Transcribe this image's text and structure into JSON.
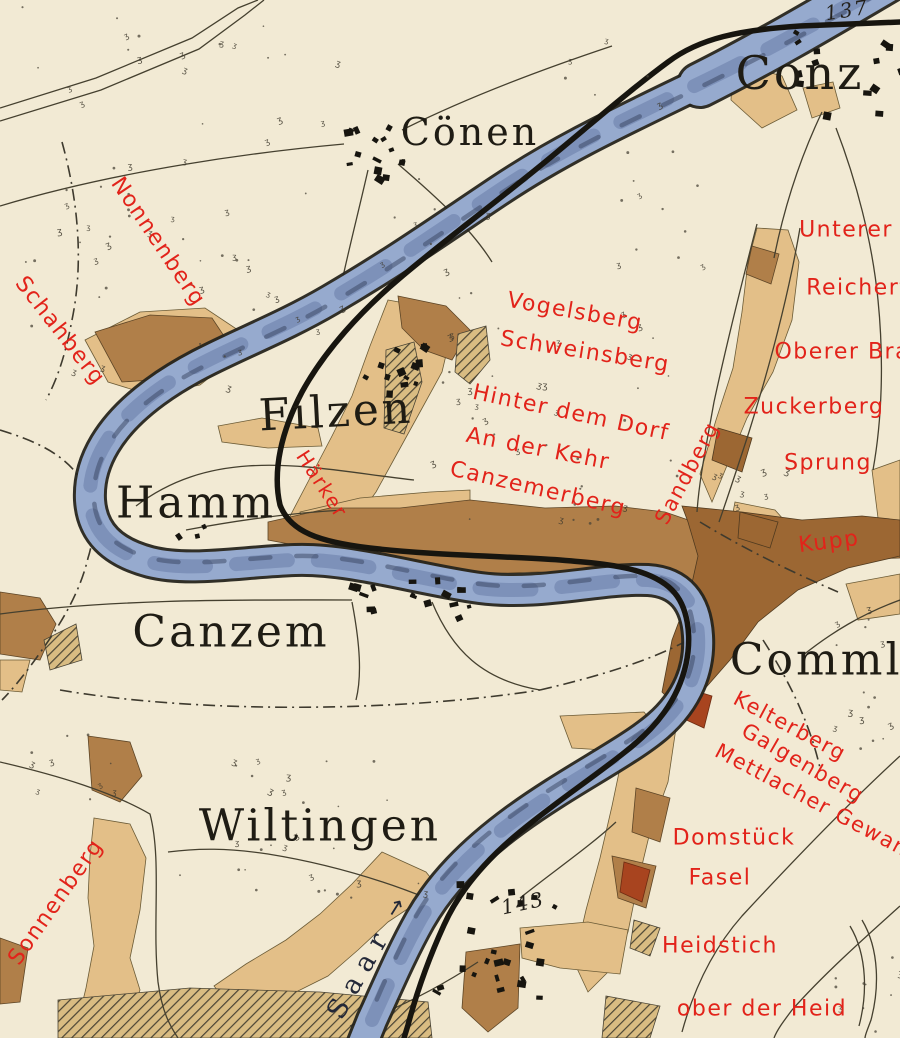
{
  "map_type": "historical topographic wine map",
  "colors": {
    "paper": "#f2ead4",
    "tan": "#e3bf88",
    "brown": "#b07f49",
    "brown2": "#9c6733",
    "redbrown": "#a8441f",
    "river": "#96aace",
    "bank": "#26251d",
    "ink": "#17150f",
    "red": "#e2231a",
    "road": "#45402f",
    "town": "#1f1c14",
    "hydro": "#232838"
  },
  "river": {
    "name": "Saar",
    "arrow": "→"
  },
  "labels": [
    {
      "text": "Cönen",
      "x": 470,
      "y": 132,
      "rot": 0,
      "cls": "town",
      "size": 38
    },
    {
      "text": "Conz",
      "x": 800,
      "y": 73,
      "rot": 0,
      "cls": "town",
      "size": 46
    },
    {
      "text": "Filzen",
      "x": 336,
      "y": 412,
      "rot": -3,
      "cls": "town",
      "size": 44
    },
    {
      "text": "Hamm",
      "x": 196,
      "y": 503,
      "rot": 0,
      "cls": "town",
      "size": 44
    },
    {
      "text": "Canzem",
      "x": 231,
      "y": 632,
      "rot": 0,
      "cls": "town",
      "size": 44
    },
    {
      "text": "Wiltingen",
      "x": 320,
      "y": 826,
      "rot": 0,
      "cls": "town",
      "size": 44
    },
    {
      "text": "Commling",
      "x": 856,
      "y": 660,
      "rot": 0,
      "cls": "town",
      "size": 44
    },
    {
      "text": "137",
      "x": 847,
      "y": 10,
      "rot": -9,
      "cls": "elev",
      "size": 20
    },
    {
      "text": "143",
      "x": 523,
      "y": 903,
      "rot": -12,
      "cls": "elev",
      "size": 20
    },
    {
      "text": "Saar",
      "x": 360,
      "y": 972,
      "rot": -60,
      "cls": "hydro",
      "size": 27
    },
    {
      "text": "→",
      "x": 396,
      "y": 908,
      "rot": -58,
      "cls": "hydro-arrow",
      "size": 22
    },
    {
      "text": "Nonnenberg",
      "x": 158,
      "y": 242,
      "rot": 56,
      "cls": "vineyard",
      "size": 22
    },
    {
      "text": "Schahberg",
      "x": 60,
      "y": 331,
      "rot": 52,
      "cls": "vineyard",
      "size": 22
    },
    {
      "text": "Unterer",
      "x": 846,
      "y": 230,
      "rot": 0,
      "cls": "vineyard",
      "size": 22
    },
    {
      "text": "Reichertsb",
      "x": 872,
      "y": 288,
      "rot": 0,
      "cls": "vineyard",
      "size": 22
    },
    {
      "text": "Oberer Brau",
      "x": 850,
      "y": 352,
      "rot": 0,
      "cls": "vineyard",
      "size": 22
    },
    {
      "text": "Zuckerberg",
      "x": 814,
      "y": 407,
      "rot": 0,
      "cls": "vineyard",
      "size": 22
    },
    {
      "text": "Sprung",
      "x": 828,
      "y": 463,
      "rot": 0,
      "cls": "vineyard",
      "size": 22
    },
    {
      "text": "Vogelsberg",
      "x": 575,
      "y": 312,
      "rot": 10,
      "cls": "vineyard",
      "size": 22
    },
    {
      "text": "Schweinsberg",
      "x": 585,
      "y": 352,
      "rot": 9,
      "cls": "vineyard",
      "size": 22
    },
    {
      "text": "Hinter dem Dorf",
      "x": 571,
      "y": 413,
      "rot": 12,
      "cls": "vineyard",
      "size": 22
    },
    {
      "text": "An der Kehr",
      "x": 538,
      "y": 449,
      "rot": 11,
      "cls": "vineyard",
      "size": 22
    },
    {
      "text": "Canzemerberg",
      "x": 538,
      "y": 489,
      "rot": 13,
      "cls": "vineyard",
      "size": 22
    },
    {
      "text": "Sandberg",
      "x": 687,
      "y": 473,
      "rot": -62,
      "cls": "vineyard",
      "size": 21
    },
    {
      "text": "Härker",
      "x": 322,
      "y": 484,
      "rot": 57,
      "cls": "vineyard",
      "size": 20
    },
    {
      "text": "Kupp",
      "x": 829,
      "y": 542,
      "rot": -7,
      "cls": "vineyard",
      "size": 22
    },
    {
      "text": "Kelterberg",
      "x": 790,
      "y": 726,
      "rot": 28,
      "cls": "vineyard",
      "size": 21
    },
    {
      "text": "Galgenberg",
      "x": 803,
      "y": 763,
      "rot": 30,
      "cls": "vineyard",
      "size": 21
    },
    {
      "text": "Mettlacher Gewan",
      "x": 812,
      "y": 800,
      "rot": 28,
      "cls": "vineyard",
      "size": 21
    },
    {
      "text": "Domstück",
      "x": 734,
      "y": 838,
      "rot": 0,
      "cls": "vineyard",
      "size": 22
    },
    {
      "text": "Fasel",
      "x": 720,
      "y": 878,
      "rot": 0,
      "cls": "vineyard",
      "size": 22
    },
    {
      "text": "Heidstich",
      "x": 720,
      "y": 946,
      "rot": 0,
      "cls": "vineyard",
      "size": 22
    },
    {
      "text": "ober der Heid",
      "x": 762,
      "y": 1009,
      "rot": 0,
      "cls": "vineyard",
      "size": 22
    },
    {
      "text": "Sonnenberg",
      "x": 56,
      "y": 902,
      "rot": -55,
      "cls": "vineyard",
      "size": 22
    }
  ],
  "villages": [
    {
      "name": "coenen",
      "x": 372,
      "y": 148,
      "w": 62,
      "h": 56,
      "n": 15
    },
    {
      "name": "conz",
      "x": 848,
      "y": 70,
      "w": 108,
      "h": 85,
      "n": 15
    },
    {
      "name": "filzen",
      "x": 393,
      "y": 360,
      "w": 66,
      "h": 64,
      "n": 13
    },
    {
      "name": "canzem",
      "x": 409,
      "y": 597,
      "w": 118,
      "h": 44,
      "n": 17
    },
    {
      "name": "wiltingen",
      "x": 492,
      "y": 938,
      "w": 125,
      "h": 115,
      "n": 24
    },
    {
      "name": "hamm",
      "x": 189,
      "y": 532,
      "w": 28,
      "h": 16,
      "n": 3
    }
  ],
  "scrub_areas": [
    {
      "x": 10,
      "y": 5,
      "w": 340,
      "h": 330,
      "n": 42
    },
    {
      "x": 60,
      "y": 150,
      "w": 190,
      "h": 250,
      "n": 26
    },
    {
      "x": 360,
      "y": 170,
      "w": 130,
      "h": 130,
      "n": 10
    },
    {
      "x": 430,
      "y": 290,
      "w": 250,
      "h": 240,
      "n": 40
    },
    {
      "x": 545,
      "y": 30,
      "w": 120,
      "h": 90,
      "n": 6
    },
    {
      "x": 826,
      "y": 608,
      "w": 74,
      "h": 160,
      "n": 16
    },
    {
      "x": 688,
      "y": 470,
      "w": 100,
      "h": 50,
      "n": 8
    },
    {
      "x": 150,
      "y": 836,
      "w": 300,
      "h": 70,
      "n": 18
    },
    {
      "x": 0,
      "y": 700,
      "w": 130,
      "h": 120,
      "n": 10
    },
    {
      "x": 834,
      "y": 956,
      "w": 66,
      "h": 80,
      "n": 10
    },
    {
      "x": 208,
      "y": 748,
      "w": 180,
      "h": 70,
      "n": 12
    },
    {
      "x": 596,
      "y": 120,
      "w": 110,
      "h": 150,
      "n": 12
    }
  ]
}
